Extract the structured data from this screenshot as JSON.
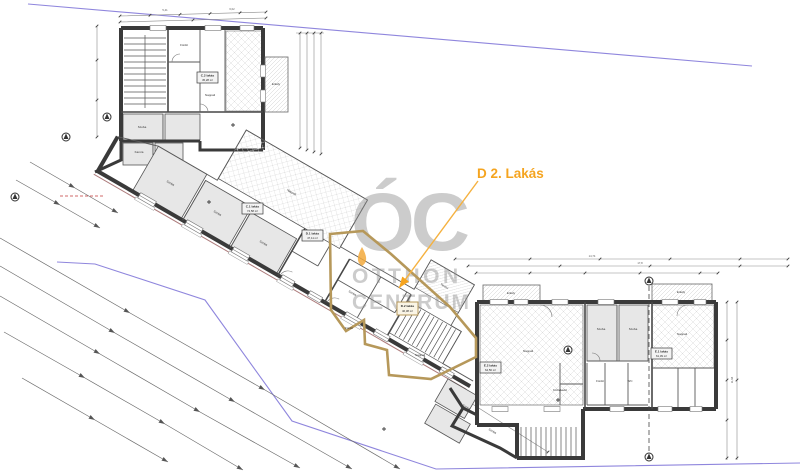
{
  "highlight": {
    "label": "D 2. Lakás",
    "outline_color": "#b6985a",
    "label_color": "#f5a41f"
  },
  "watermark": {
    "logo": "ÓC",
    "line1": "OTTHON",
    "line2": "CENTRUM",
    "color": "#8f8f8f",
    "drop_color": "#f2a93c"
  },
  "apartments": [
    {
      "label": "C.2 lakás",
      "area": "45,28 m²"
    },
    {
      "label": "C.1 lakás",
      "area": "74,58 m²"
    },
    {
      "label": "D.1 lakás",
      "area": "47,11 m²"
    },
    {
      "label": "D.2 lakás",
      "area": "46,38 m²"
    },
    {
      "label": "E.2 lakás",
      "area": "64,56 m²"
    },
    {
      "label": "E.1 lakás",
      "area": "61,39 m²"
    }
  ],
  "rooms": [
    "Erkély",
    "Fürdő",
    "Nappali",
    "Szoba",
    "Szoba",
    "Szoba",
    "Szoba",
    "Nappali",
    "Terasz",
    "Szoba",
    "Nappali",
    "Fürdő",
    "Nappali",
    "Szoba",
    "Szoba",
    "Nappali",
    "Erkély",
    "Erkély",
    "Szoba",
    "Szoba",
    "Fürdő",
    "Kamra",
    "Közlekedő",
    "WC"
  ],
  "dimensions": [
    "5,41",
    "6,02",
    "14,74",
    "17,8",
    "11,94"
  ],
  "colors": {
    "boundary_purple": "#8f86dd",
    "wall_dark": "#3a3a3a",
    "survey_line": "#6b6b6b",
    "red_dash": "#d06868"
  }
}
